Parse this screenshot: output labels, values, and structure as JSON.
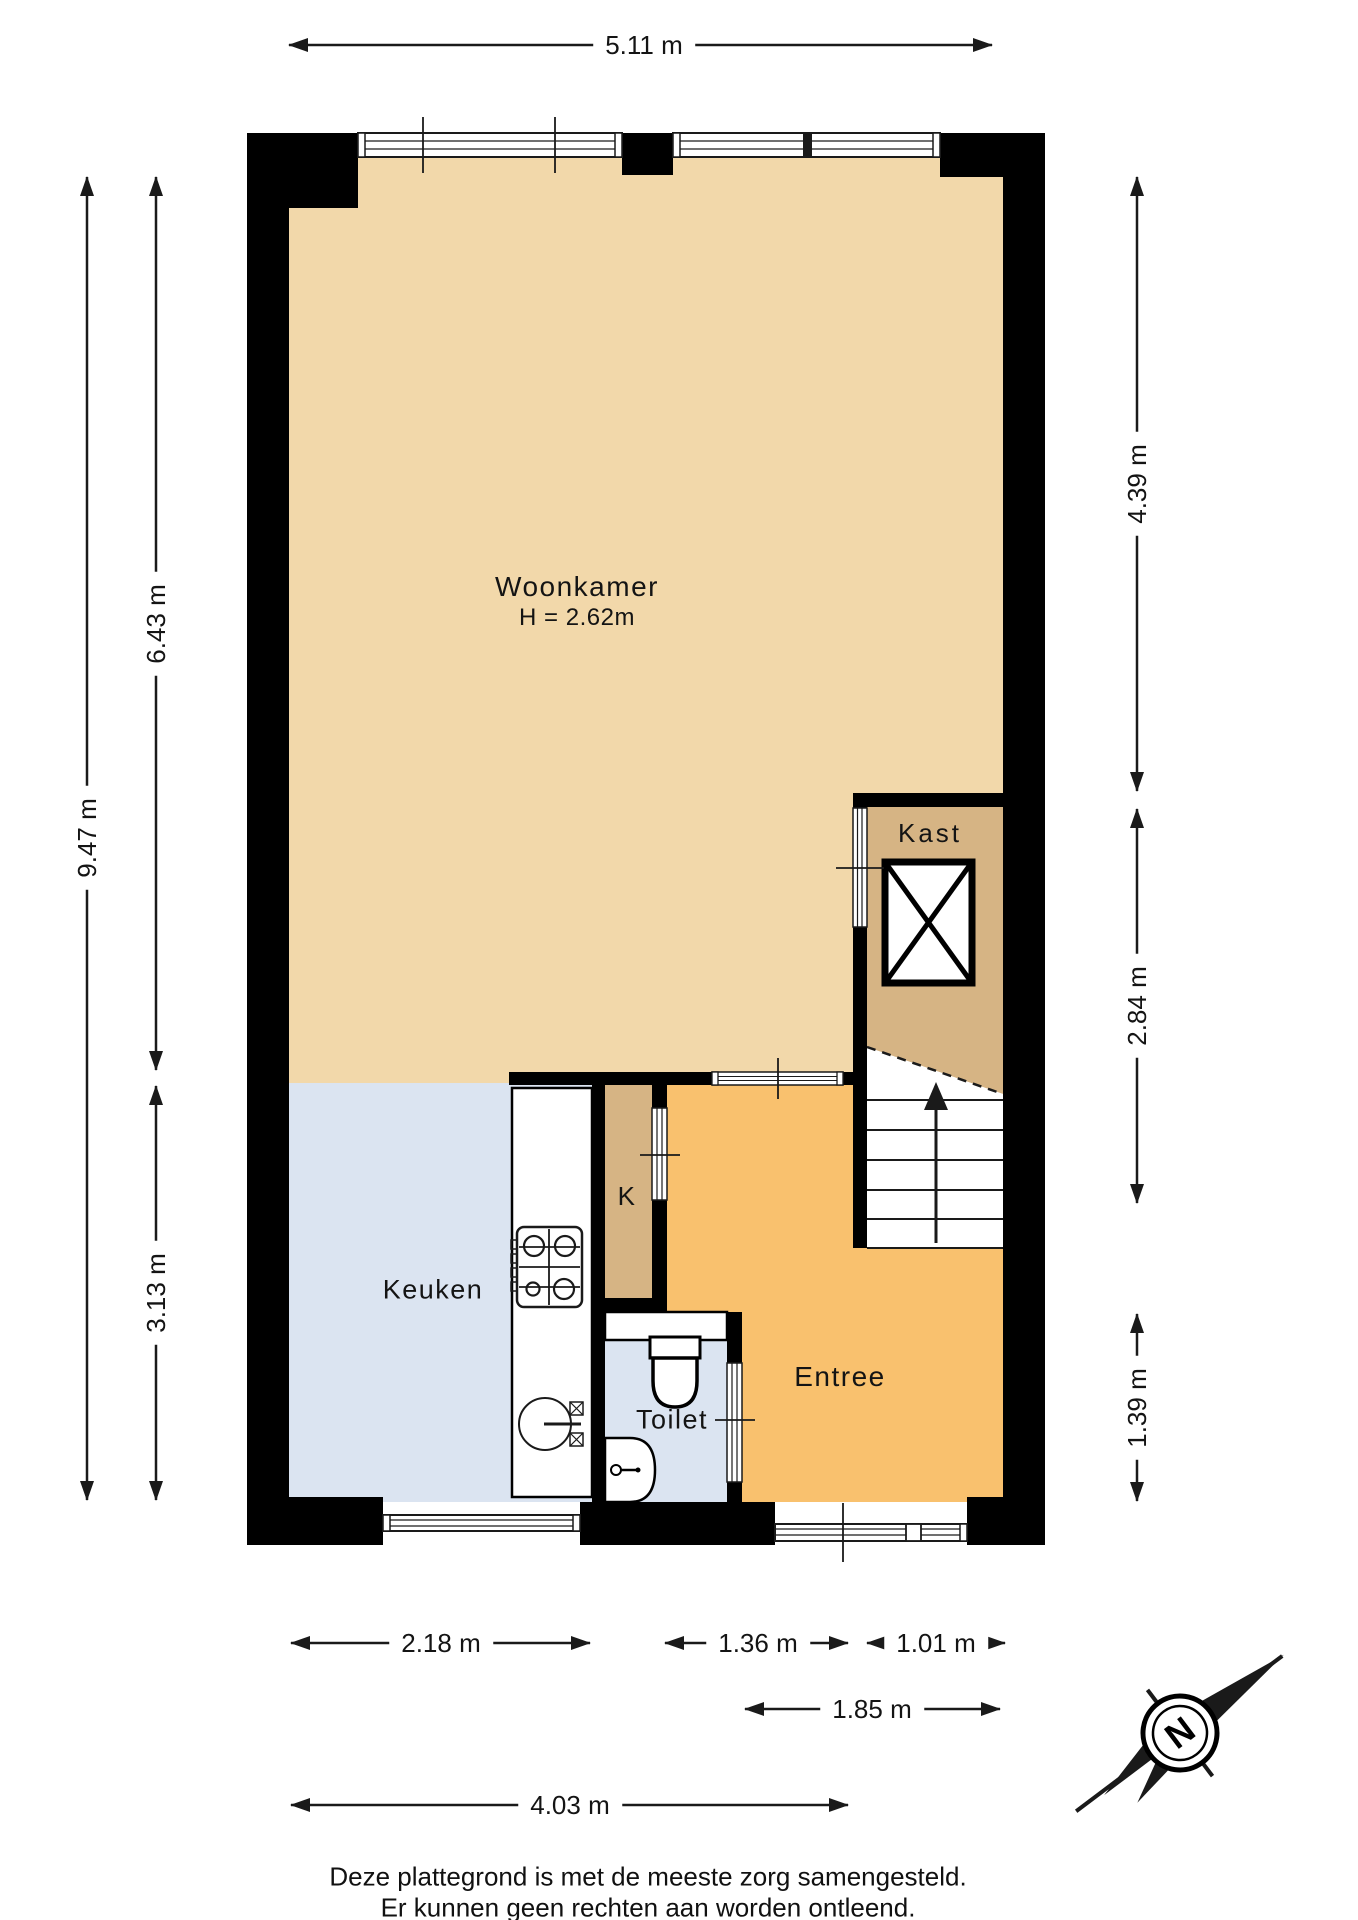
{
  "rooms": {
    "woonkamer": {
      "label": "Woonkamer",
      "height_note": "H = 2.62m"
    },
    "kast": {
      "label": "Kast"
    },
    "keuken": {
      "label": "Keuken"
    },
    "k_closet": {
      "label": "K"
    },
    "toilet": {
      "label": "Toilet"
    },
    "entree": {
      "label": "Entree"
    }
  },
  "dimensions": {
    "top_width": "5.11 m",
    "left_total": "9.47 m",
    "left_upper": "6.43 m",
    "left_lower": "3.13 m",
    "right_upper": "4.39 m",
    "right_middle": "2.84 m",
    "right_lower": "1.39 m",
    "bottom_keuken": "2.18 m",
    "bottom_middle": "1.36 m",
    "bottom_stairs": "1.01 m",
    "bottom_entree": "1.85 m",
    "bottom_total": "4.03 m"
  },
  "compass": {
    "north_label": "N"
  },
  "footer": {
    "line1": "Deze plattegrond is met de meeste zorg samengesteld.",
    "line2": "Er kunnen geen rechten aan worden ontleend."
  },
  "colors": {
    "woonkamer": "#f2d8aa",
    "kast": "#d6b484",
    "keuken": "#dbe4f1",
    "entree": "#f9c16e",
    "wall": "#000000",
    "line": "#1a1a1a"
  }
}
